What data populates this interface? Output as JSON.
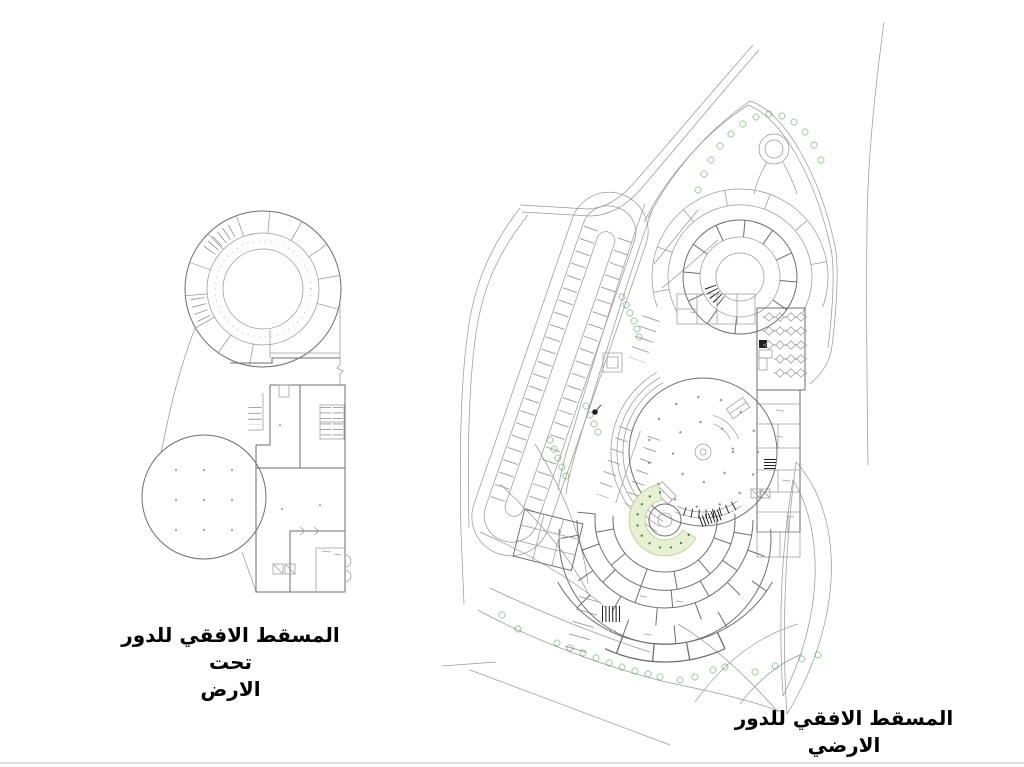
{
  "slide": {
    "background": "#ffffff"
  },
  "figures": {
    "basement_plan": {
      "caption_line1": "المسقط الافقي للدور تحت",
      "caption_line2": "الارض"
    },
    "ground_plan": {
      "caption": "المسقط الافقي للدور الارضي"
    }
  },
  "colors": {
    "line": "#9a9a9a",
    "wall": "#6e6e6e",
    "ink": "#1f1f1f",
    "tree": "#41c23e",
    "treedark": "#2e9130",
    "lawn": "#e7f0d3",
    "lawnedge": "#a9c97c",
    "caption": "#000000",
    "edge": "#dde0e3"
  }
}
